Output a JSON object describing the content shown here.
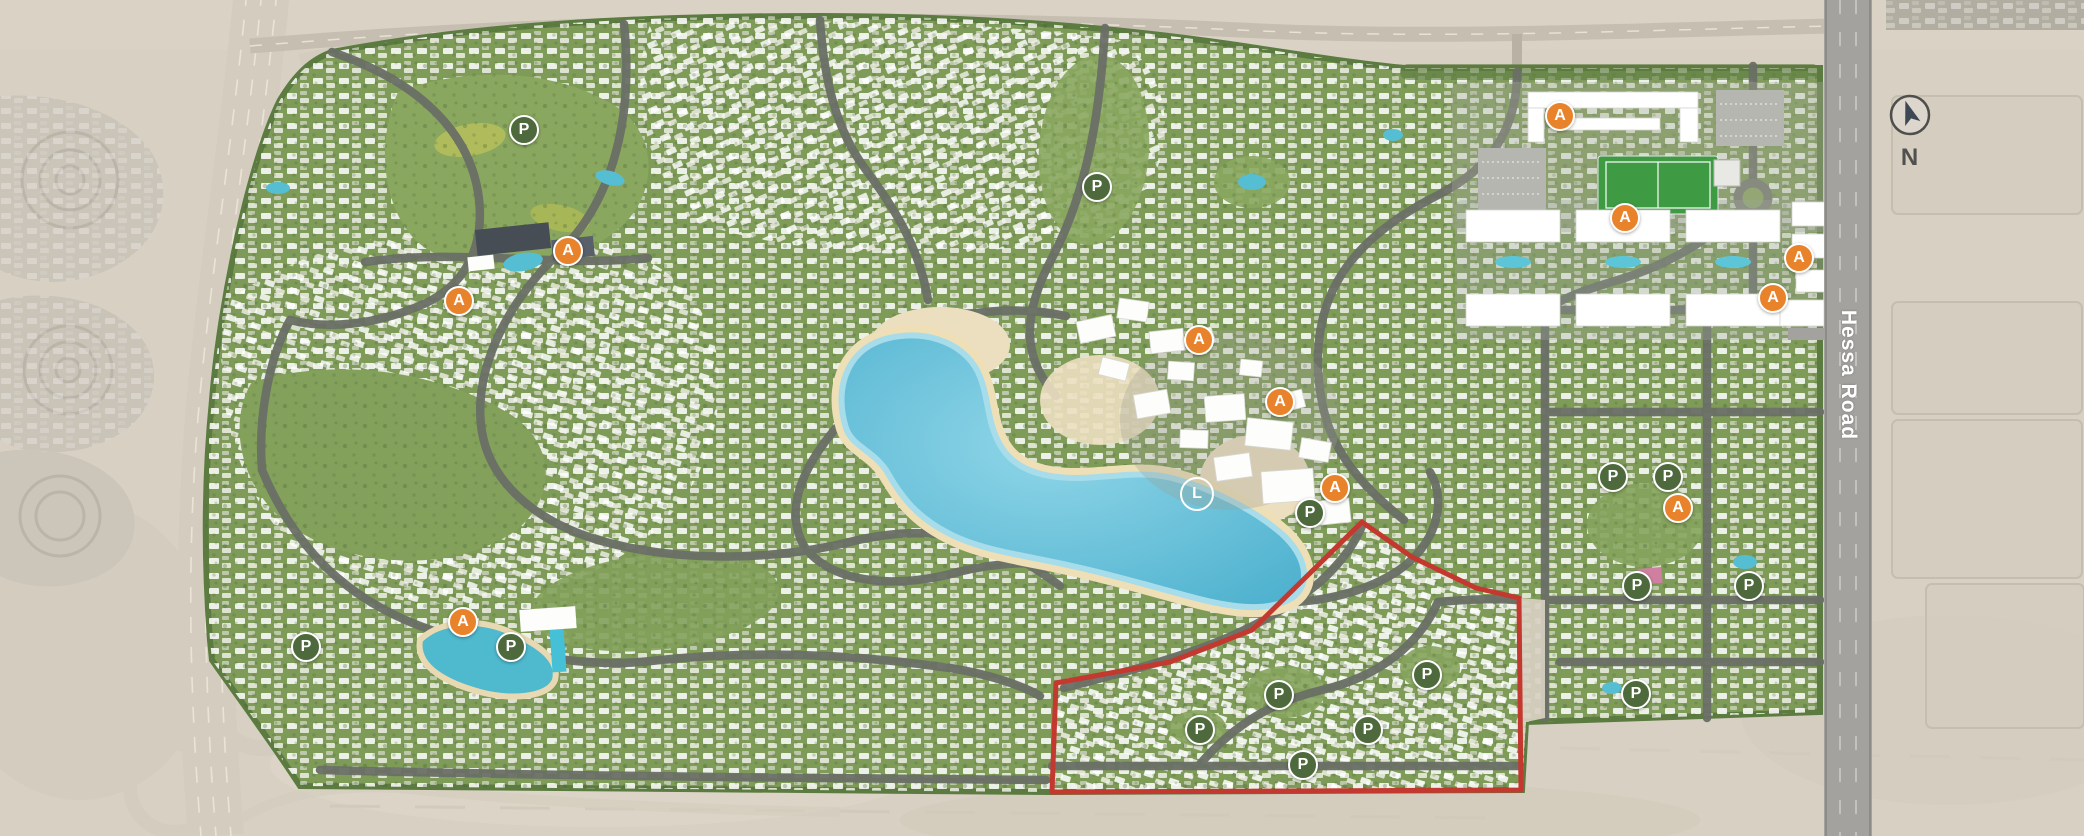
{
  "title": "Residential community master plan - aerial view",
  "map": {
    "road_label": "Hessa Road",
    "compass_label": "N",
    "marker_letters": {
      "A": "A",
      "P": "P",
      "L": "L"
    },
    "marker_meaning": {
      "A": "amenity",
      "P": "park",
      "L": "lagoon"
    },
    "colors": {
      "desert": "#d8d0c2",
      "greenery": "#7d9a56",
      "road": "#6a6f66",
      "highway": "#d4cdbf",
      "lake": "#58b7d3",
      "beach": "#eedfb6",
      "houses": "#ffffff",
      "marker_amenity": "#e8822b",
      "marker_park": "#4e6a3d",
      "boundary": "#c3392f",
      "sports_field": "#3f9b43"
    },
    "red_zone_points": "1052,792 1056,683 1170,662 1252,630 1362,522 1412,557 1476,588 1519,598 1521,790",
    "markers": [
      {
        "type": "A",
        "x": 568,
        "y": 251
      },
      {
        "type": "A",
        "x": 459,
        "y": 301
      },
      {
        "type": "A",
        "x": 463,
        "y": 622
      },
      {
        "type": "A",
        "x": 1199,
        "y": 340
      },
      {
        "type": "A",
        "x": 1280,
        "y": 402
      },
      {
        "type": "A",
        "x": 1335,
        "y": 488
      },
      {
        "type": "A",
        "x": 1560,
        "y": 116
      },
      {
        "type": "A",
        "x": 1625,
        "y": 218
      },
      {
        "type": "A",
        "x": 1799,
        "y": 258
      },
      {
        "type": "A",
        "x": 1773,
        "y": 298
      },
      {
        "type": "A",
        "x": 1678,
        "y": 508
      },
      {
        "type": "P",
        "x": 524,
        "y": 130
      },
      {
        "type": "P",
        "x": 1097,
        "y": 187
      },
      {
        "type": "P",
        "x": 306,
        "y": 647
      },
      {
        "type": "P",
        "x": 511,
        "y": 647
      },
      {
        "type": "P",
        "x": 1310,
        "y": 513
      },
      {
        "type": "P",
        "x": 1613,
        "y": 477
      },
      {
        "type": "P",
        "x": 1668,
        "y": 477
      },
      {
        "type": "P",
        "x": 1637,
        "y": 586
      },
      {
        "type": "P",
        "x": 1749,
        "y": 586
      },
      {
        "type": "P",
        "x": 1636,
        "y": 694
      },
      {
        "type": "P",
        "x": 1427,
        "y": 675
      },
      {
        "type": "P",
        "x": 1279,
        "y": 695
      },
      {
        "type": "P",
        "x": 1200,
        "y": 730
      },
      {
        "type": "P",
        "x": 1368,
        "y": 730
      },
      {
        "type": "P",
        "x": 1303,
        "y": 765
      },
      {
        "type": "L",
        "x": 1197,
        "y": 494
      }
    ]
  }
}
